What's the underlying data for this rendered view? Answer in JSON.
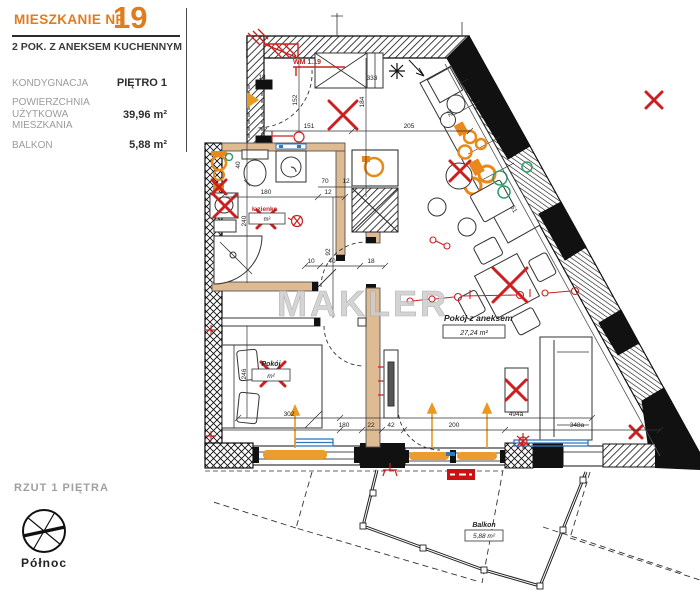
{
  "panel": {
    "title_label": "MIESZKANIE NR",
    "title_number": "19",
    "subtitle": "2 POK. Z ANEKSEM KUCHENNYM",
    "rows": [
      {
        "label": "KONDYGNACJA",
        "value": "PIĘTRO 1"
      },
      {
        "label": "POWIERZCHNIA UŻYTKOWA MIESZKANIA",
        "value": "39,96 m²"
      },
      {
        "label": "BALKON",
        "value": "5,88 m²"
      }
    ],
    "floor_caption": "RZUT 1 PIĘTRA",
    "compass_label": "Północ",
    "accent_color": "#E07C1E"
  },
  "plan": {
    "watermark": "MAKLER",
    "wm_label": "WM 1.19",
    "labels": {
      "lazienka": "łazienka",
      "lazienka_area": "m²",
      "pokoj": "Pokój",
      "pokoj_area": "m²",
      "aneks": "Pokój z aneksem",
      "aneks_area": "27,24 m²",
      "balkon": "Balkon",
      "balkon_area": "5,88 m²"
    },
    "dims": {
      "t151": "151",
      "t205": "205",
      "v152": "152",
      "v184": "184",
      "t333": "333",
      "d72": "72",
      "d51": "51",
      "b180": "180",
      "b12": "12",
      "v40": "40",
      "v240": "240",
      "m70": "70",
      "m12": "12",
      "h92": "92",
      "h10": "10",
      "h40": "40",
      "h18": "18",
      "w302": "302",
      "w494": "494a",
      "w180": "180",
      "w22": "22",
      "w42": "42",
      "w200": "200",
      "w348": "348a",
      "e18": "18",
      "v246": "246"
    },
    "colors": {
      "wall_black": "#111111",
      "partition_tan": "#debb92",
      "accent_orange": "#E8891A",
      "annotation_red": "#CC2020",
      "radiator_blue": "#3377BB",
      "plant_green": "#2AA06A",
      "watermark_gray": "#CDCDCD"
    }
  }
}
